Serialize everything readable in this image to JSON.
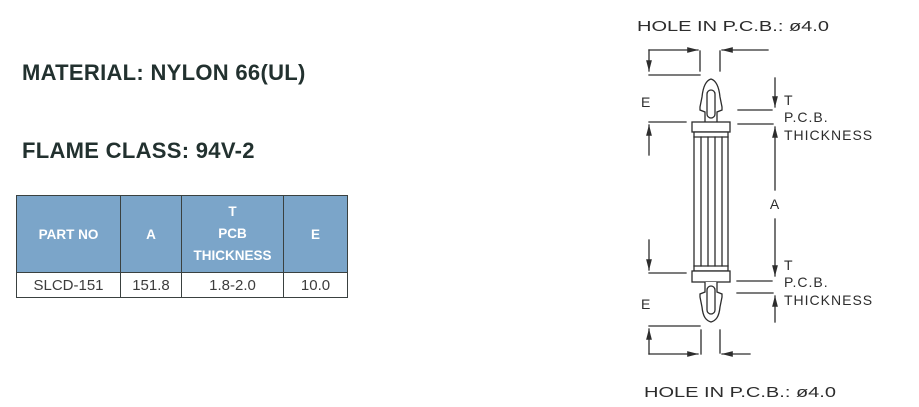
{
  "specs": {
    "material": "MATERIAL: NYLON 66(UL)",
    "flame_class": "FLAME CLASS: 94V-2",
    "color": "COLOR: NATURAL"
  },
  "table": {
    "columns": [
      {
        "label": "PART NO"
      },
      {
        "label": "A"
      },
      {
        "label_lines": [
          "T",
          "PCB",
          "THICKNESS"
        ]
      },
      {
        "label": "E"
      }
    ],
    "rows": [
      [
        "SLCD-151",
        "151.8",
        "1.8-2.0",
        "10.0"
      ]
    ]
  },
  "diagram": {
    "hole_note_top": "HOLE IN P.C.B.: ø4.0",
    "hole_note_bottom": "HOLE IN P.C.B.: ø4.0",
    "labels": {
      "e_top": "E",
      "e_bottom": "E",
      "a": "A",
      "t_top": "T",
      "pcb_top": "P.C.B.",
      "thickness_top": "THICKNESS",
      "t_bottom": "T",
      "pcb_bottom": "P.C.B.",
      "thickness_bottom": "THICKNESS"
    }
  },
  "colors": {
    "header_bg": "#7ba5c9",
    "header_text": "#ffffff",
    "spec_text": "#22312f",
    "line": "#2d2d2d",
    "table_border": "#3a4140",
    "cell_text": "#3c3c3c"
  }
}
